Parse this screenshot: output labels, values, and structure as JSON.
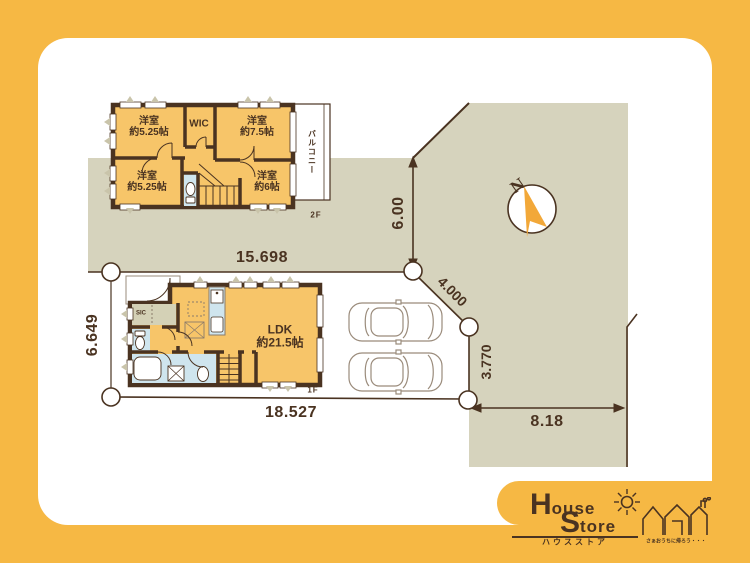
{
  "floor2": {
    "label": "2F",
    "room_tl": {
      "name": "洋室",
      "size": "約5.25帖"
    },
    "room_wic": {
      "name": "WIC"
    },
    "room_tr": {
      "name": "洋室",
      "size": "約7.5帖"
    },
    "room_bl": {
      "name": "洋室",
      "size": "約5.25帖"
    },
    "room_br": {
      "name": "洋室",
      "size": "約6帖"
    },
    "balcony": "バルコニー"
  },
  "floor1": {
    "label": "1F",
    "ldk": {
      "name": "LDK",
      "size": "約21.5帖"
    },
    "sic": "SIC"
  },
  "dimensions": {
    "north_width": "15.698",
    "east_upper": "6.00",
    "diagonal": "4.000",
    "east_lower": "3.770",
    "west": "6.649",
    "south_width": "18.527",
    "road": "8.18"
  },
  "compass": {
    "north": "N"
  },
  "logo": {
    "word1_initial": "H",
    "word1_rest": "ouse",
    "word2_initial": "S",
    "word2_rest": "tore",
    "katakana": "ハウスストア",
    "tagline": "さぁおうちに帰ろう・・・"
  },
  "colors": {
    "frame_yellow": "#f6b844",
    "site_beige": "#d6d3bd",
    "room_orange": "#f7c569",
    "wet_area_blue": "#cfe5ee",
    "entry_olive": "#d4d1b6",
    "wall_brown": "#4a3321",
    "compass_orange": "#f2a839"
  }
}
